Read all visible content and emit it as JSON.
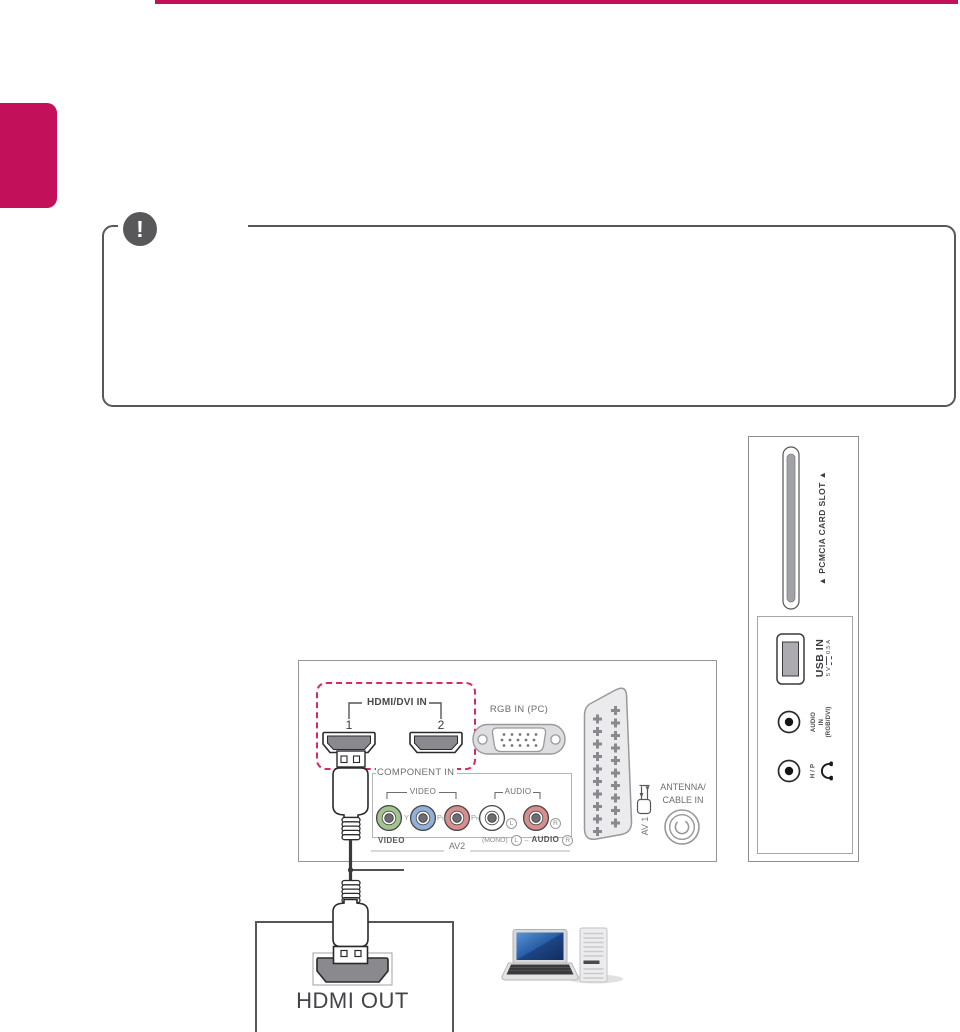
{
  "accent": {
    "magenta": "#C2115A",
    "dashed_pink": "#D92A5F"
  },
  "note": {
    "icon_glyph": "!"
  },
  "rear_panel": {
    "hdmi_group": {
      "label": "HDMI/DVI IN",
      "port1": "1",
      "port2": "2"
    },
    "rgb_label": "RGB IN (PC)",
    "component": {
      "label": "COMPONENT IN",
      "video": "VIDEO",
      "audio": "AUDIO",
      "y": "Y",
      "pb_main": "P",
      "pb_sub": "B",
      "pr_main": "P",
      "pr_sub": "R",
      "left": "L",
      "right": "R"
    },
    "av2_row": {
      "video": "VIDEO",
      "mono": "(MONO)",
      "left": "L",
      "sep": "–",
      "audio": "AUDIO",
      "right": "R",
      "av2": "AV2"
    },
    "scart_label": "AV 1",
    "antenna": {
      "line1": "ANTENNA/",
      "line2": "CABLE IN"
    }
  },
  "side_panel": {
    "pcmcia_label": "▲ PCMCIA CARD SLOT ▲",
    "usb": {
      "label": "USB IN",
      "spec_left": "5 V",
      "spec_right": "0.5 A"
    },
    "audio_in": {
      "line1": "AUDIO",
      "line2": "IN",
      "line3": "(RGB/DVI)"
    },
    "hp_label": "H / P"
  },
  "source": {
    "hdmi_out": "HDMI OUT"
  }
}
